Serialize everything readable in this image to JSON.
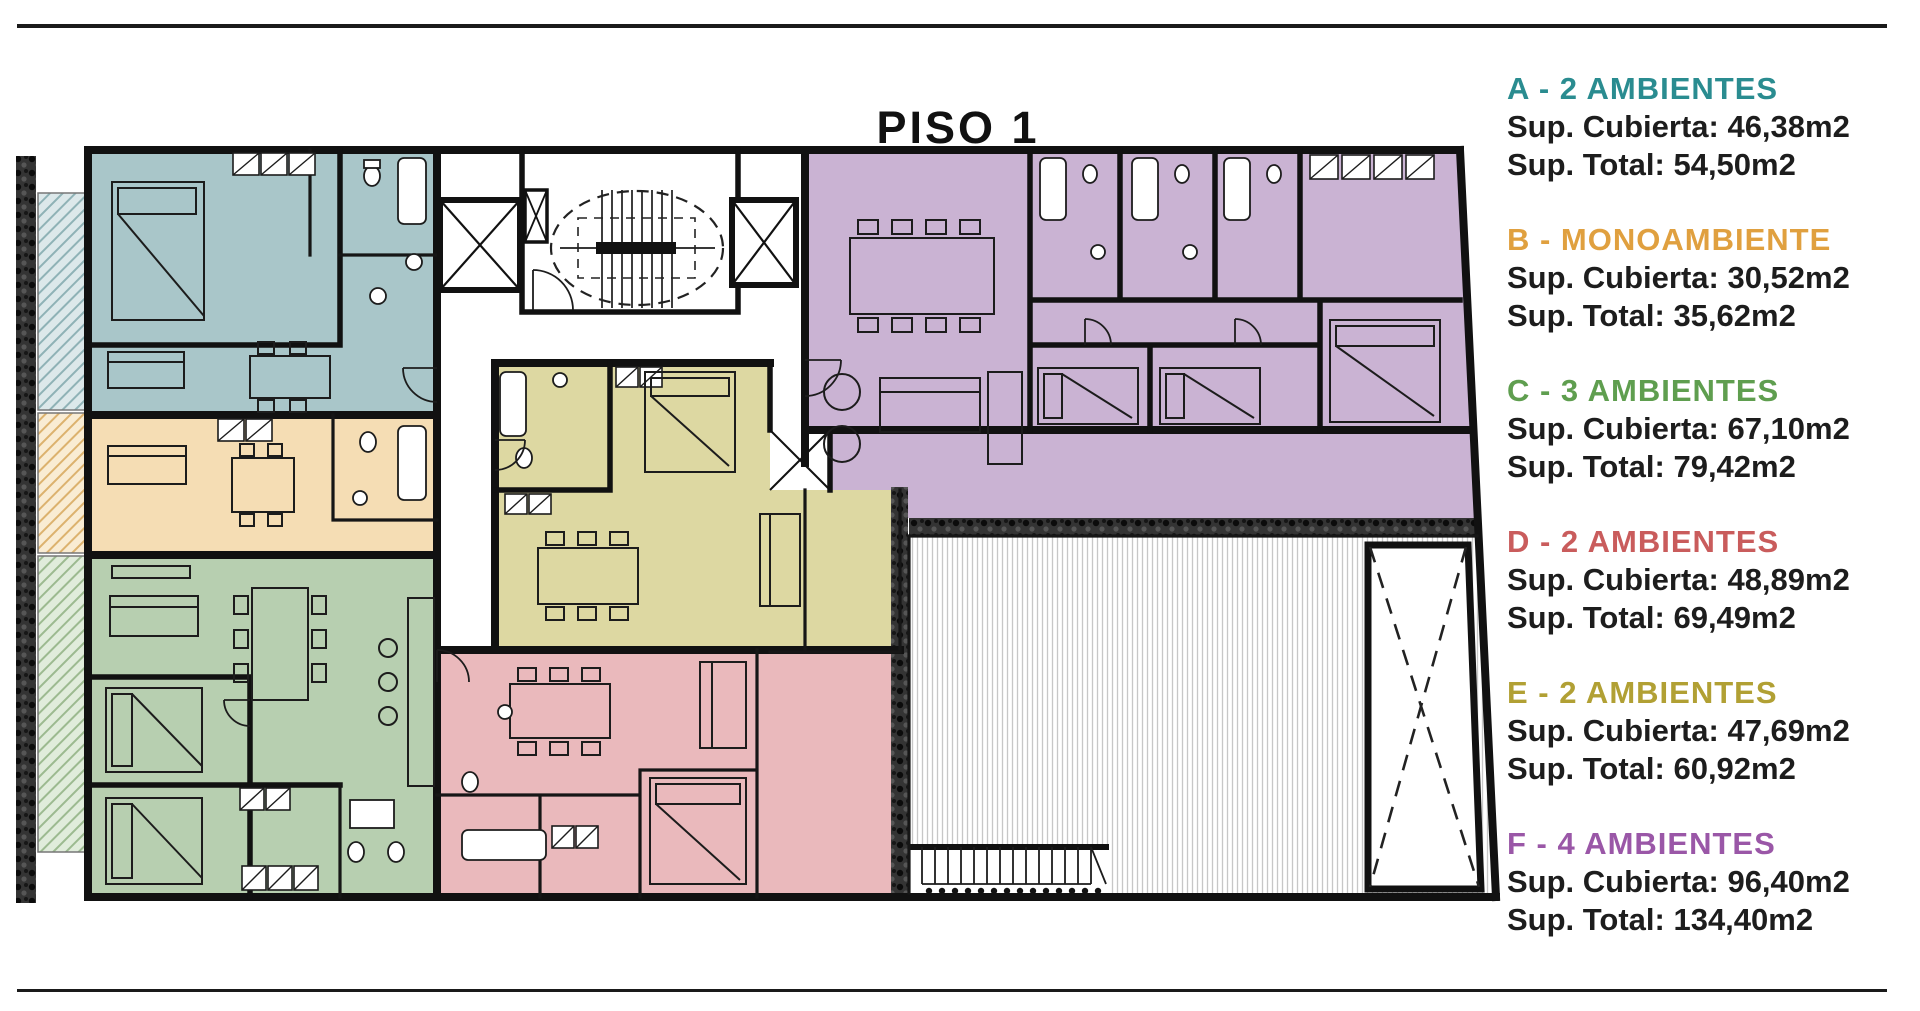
{
  "title": "PISO 1",
  "legend": {
    "items": [
      {
        "id": "A",
        "label": "A - 2 AMBIENTES",
        "color": "#2a8c90",
        "cubierta": "Sup. Cubierta: 46,38m2",
        "total": "Sup. Total: 54,50m2"
      },
      {
        "id": "B",
        "label": "B - MONOAMBIENTE",
        "color": "#e0a03f",
        "cubierta": "Sup. Cubierta: 30,52m2",
        "total": "Sup. Total: 35,62m2"
      },
      {
        "id": "C",
        "label": "C - 3 AMBIENTES",
        "color": "#5f9e4f",
        "cubierta": "Sup. Cubierta: 67,10m2",
        "total": "Sup. Total: 79,42m2"
      },
      {
        "id": "D",
        "label": "D - 2 AMBIENTES",
        "color": "#c95c5c",
        "cubierta": "Sup. Cubierta: 48,89m2",
        "total": "Sup. Total: 69,49m2"
      },
      {
        "id": "E",
        "label": "E - 2 AMBIENTES",
        "color": "#b1a034",
        "cubierta": "Sup. Cubierta: 47,69m2",
        "total": "Sup. Total: 60,92m2"
      },
      {
        "id": "F",
        "label": "F - 4 AMBIENTES",
        "color": "#9a57a7",
        "cubierta": "Sup. Cubierta: 96,40m2",
        "total": "Sup. Total: 134,40m2"
      }
    ]
  },
  "plan": {
    "floor_label": "PISO 1",
    "unit_colors": {
      "a_blue": "#a9c6c9",
      "b_tan": "#f5ddb4",
      "c_green": "#b7cfb0",
      "d_pink": "#eab9bc",
      "e_yellow": "#ddd8a2",
      "f_purple": "#cab3d3"
    }
  }
}
